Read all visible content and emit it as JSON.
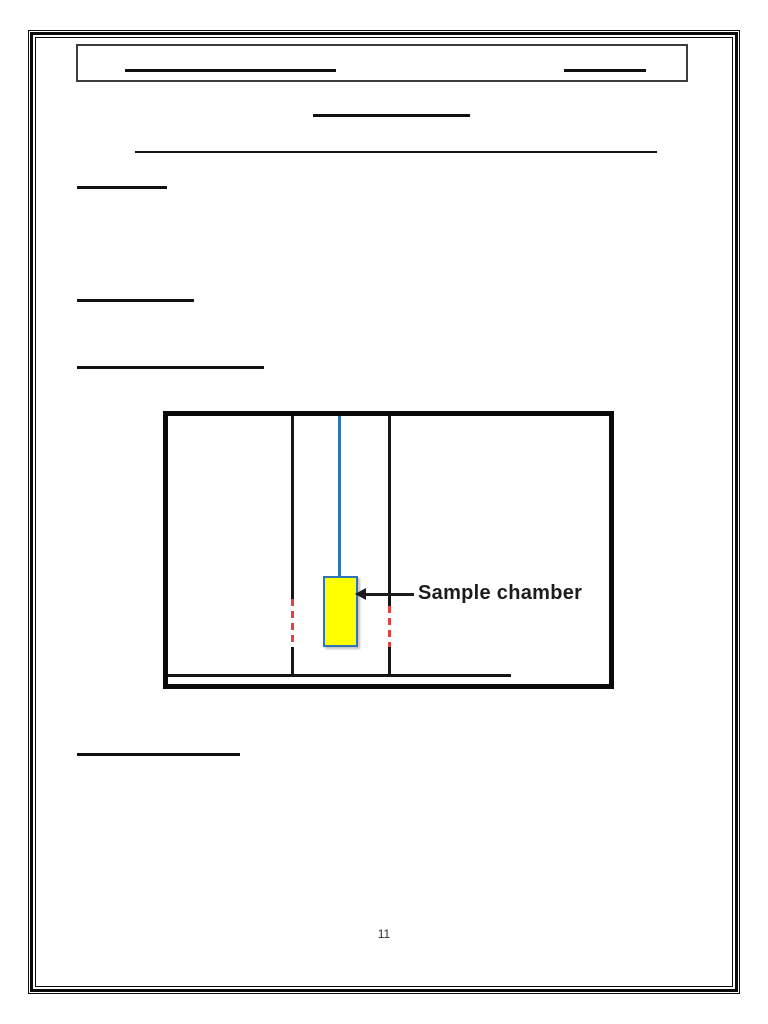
{
  "document": {
    "page_number": "11",
    "diagram": {
      "label": "Sample chamber"
    }
  },
  "colors": {
    "border_black": "#0a0a0a",
    "header_box_border": "#3c3c3c",
    "rule": "#101010",
    "tube_wall": "#151515",
    "suspension_rod_blue": "#2e74b6",
    "chamber_fill_yellow": "#ffff00",
    "chamber_border_blue": "#2e74b6",
    "heater_dash_red": "#e04343",
    "label_color": "#1c1c1c",
    "page_number_color": "#2f2f2f"
  }
}
